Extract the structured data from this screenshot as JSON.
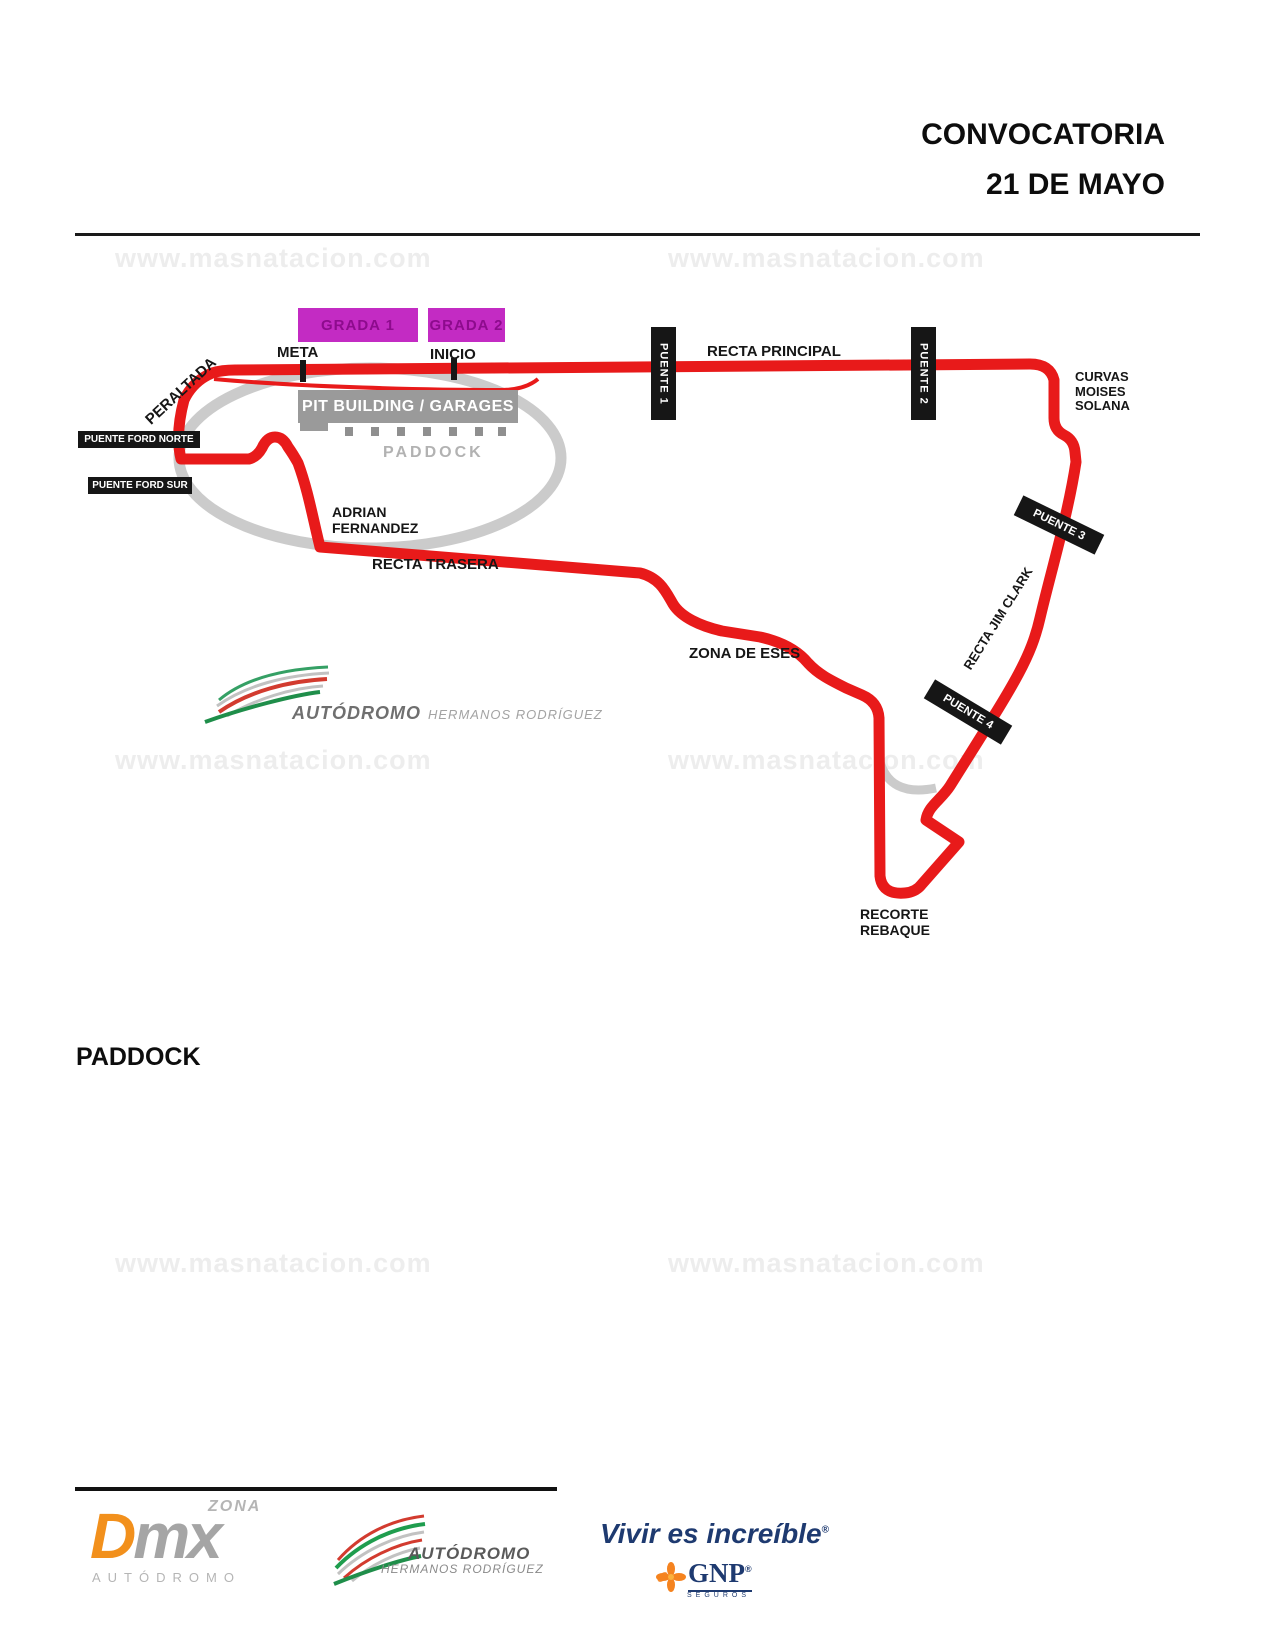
{
  "header": {
    "title_line1": "CONVOCATORIA",
    "title_line2": "21 DE MAYO"
  },
  "watermark": {
    "text": "www.masnatacion.com"
  },
  "map": {
    "labels": {
      "grada1": "GRADA 1",
      "grada2": "GRADA 2",
      "meta": "META",
      "inicio": "INICIO",
      "peraltada": "PERALTADA",
      "pit_building": "PIT BUILDING / GARAGES",
      "paddock": "PADDOCK",
      "puente_ford_norte": "PUENTE FORD NORTE",
      "puente_ford_sur": "PUENTE FORD SUR",
      "adrian_line1": "ADRIAN",
      "adrian_line2": "FERNANDEZ",
      "recta_trasera": "RECTA TRASERA",
      "puente1": "PUENTE 1",
      "recta_principal": "RECTA PRINCIPAL",
      "puente2": "PUENTE 2",
      "curvas_line1": "CURVAS",
      "curvas_line2": "MOISES",
      "curvas_line3": "SOLANA",
      "puente3": "PUENTE 3",
      "recta_jim_clark": "RECTA JIM CLARK",
      "puente4": "PUENTE 4",
      "zona_de_eses": "ZONA DE ESES",
      "recorte_line1": "RECORTE",
      "recorte_line2": "REBAQUE"
    },
    "logo": {
      "name": "AUTÓDROMO",
      "sub": "HERMANOS RODRÍGUEZ"
    }
  },
  "section": {
    "heading": "PADDOCK"
  },
  "footer": {
    "dmx": {
      "zona": "ZONA",
      "d": "D",
      "mx": "mx",
      "autodromo": "AUTÓDROMO"
    },
    "ahr": {
      "name": "AUTÓDROMO",
      "sub": "HERMANOS RODRÍGUEZ"
    },
    "gnp": {
      "slogan": "Vivir es increíble",
      "reg": "®",
      "brand": "GNP",
      "seguros": "SEGUROS"
    }
  },
  "colors": {
    "track_red": "#e81a1a",
    "oval_gray": "#cbcbcb",
    "grandstand_magenta": "#c32bc3",
    "grandstand_text": "#8d0b8d",
    "label_black": "#161616",
    "pit_gray": "#9a9a9a",
    "paddock_gray": "#b2b2b2",
    "watermark_gray": "#ededed",
    "gnp_navy": "#1e3a70",
    "gnp_orange": "#f5831f",
    "dmx_orange": "#f2901c",
    "logo_green": "#1f8e4a",
    "logo_red": "#d23b2f",
    "logo_silver": "#c2c2c2"
  }
}
